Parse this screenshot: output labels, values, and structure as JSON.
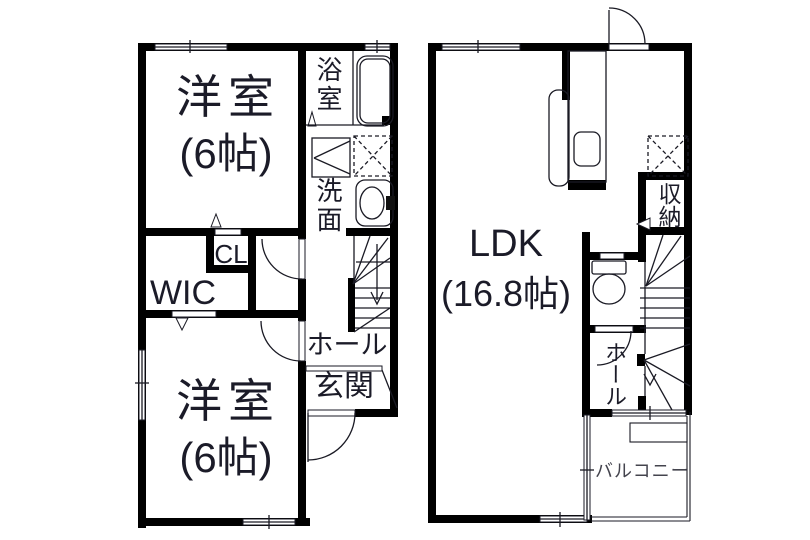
{
  "document_type": "real-estate floor plan, two stacked floor layouts side by side",
  "colors": {
    "background": "#ffffff",
    "wall": "#000000",
    "line": "#1a1a24",
    "ink": "#1b1b28",
    "balcony_ink": "#44444e"
  },
  "left_plan": {
    "bedroom_top": {
      "name": "洋室",
      "size": "(6帖)"
    },
    "bathroom": "浴室",
    "washroom": "洗面",
    "closet": "CL",
    "walk_in_closet": "WIC",
    "hall": "ホール",
    "entrance": "玄関",
    "bedroom_bottom": {
      "name": "洋室",
      "size": "(6帖)"
    }
  },
  "right_plan": {
    "ldk": {
      "name": "LDK",
      "size": "(16.8帖)"
    },
    "storage": "収納",
    "hall": "ホール",
    "balcony": "バルコニー"
  }
}
